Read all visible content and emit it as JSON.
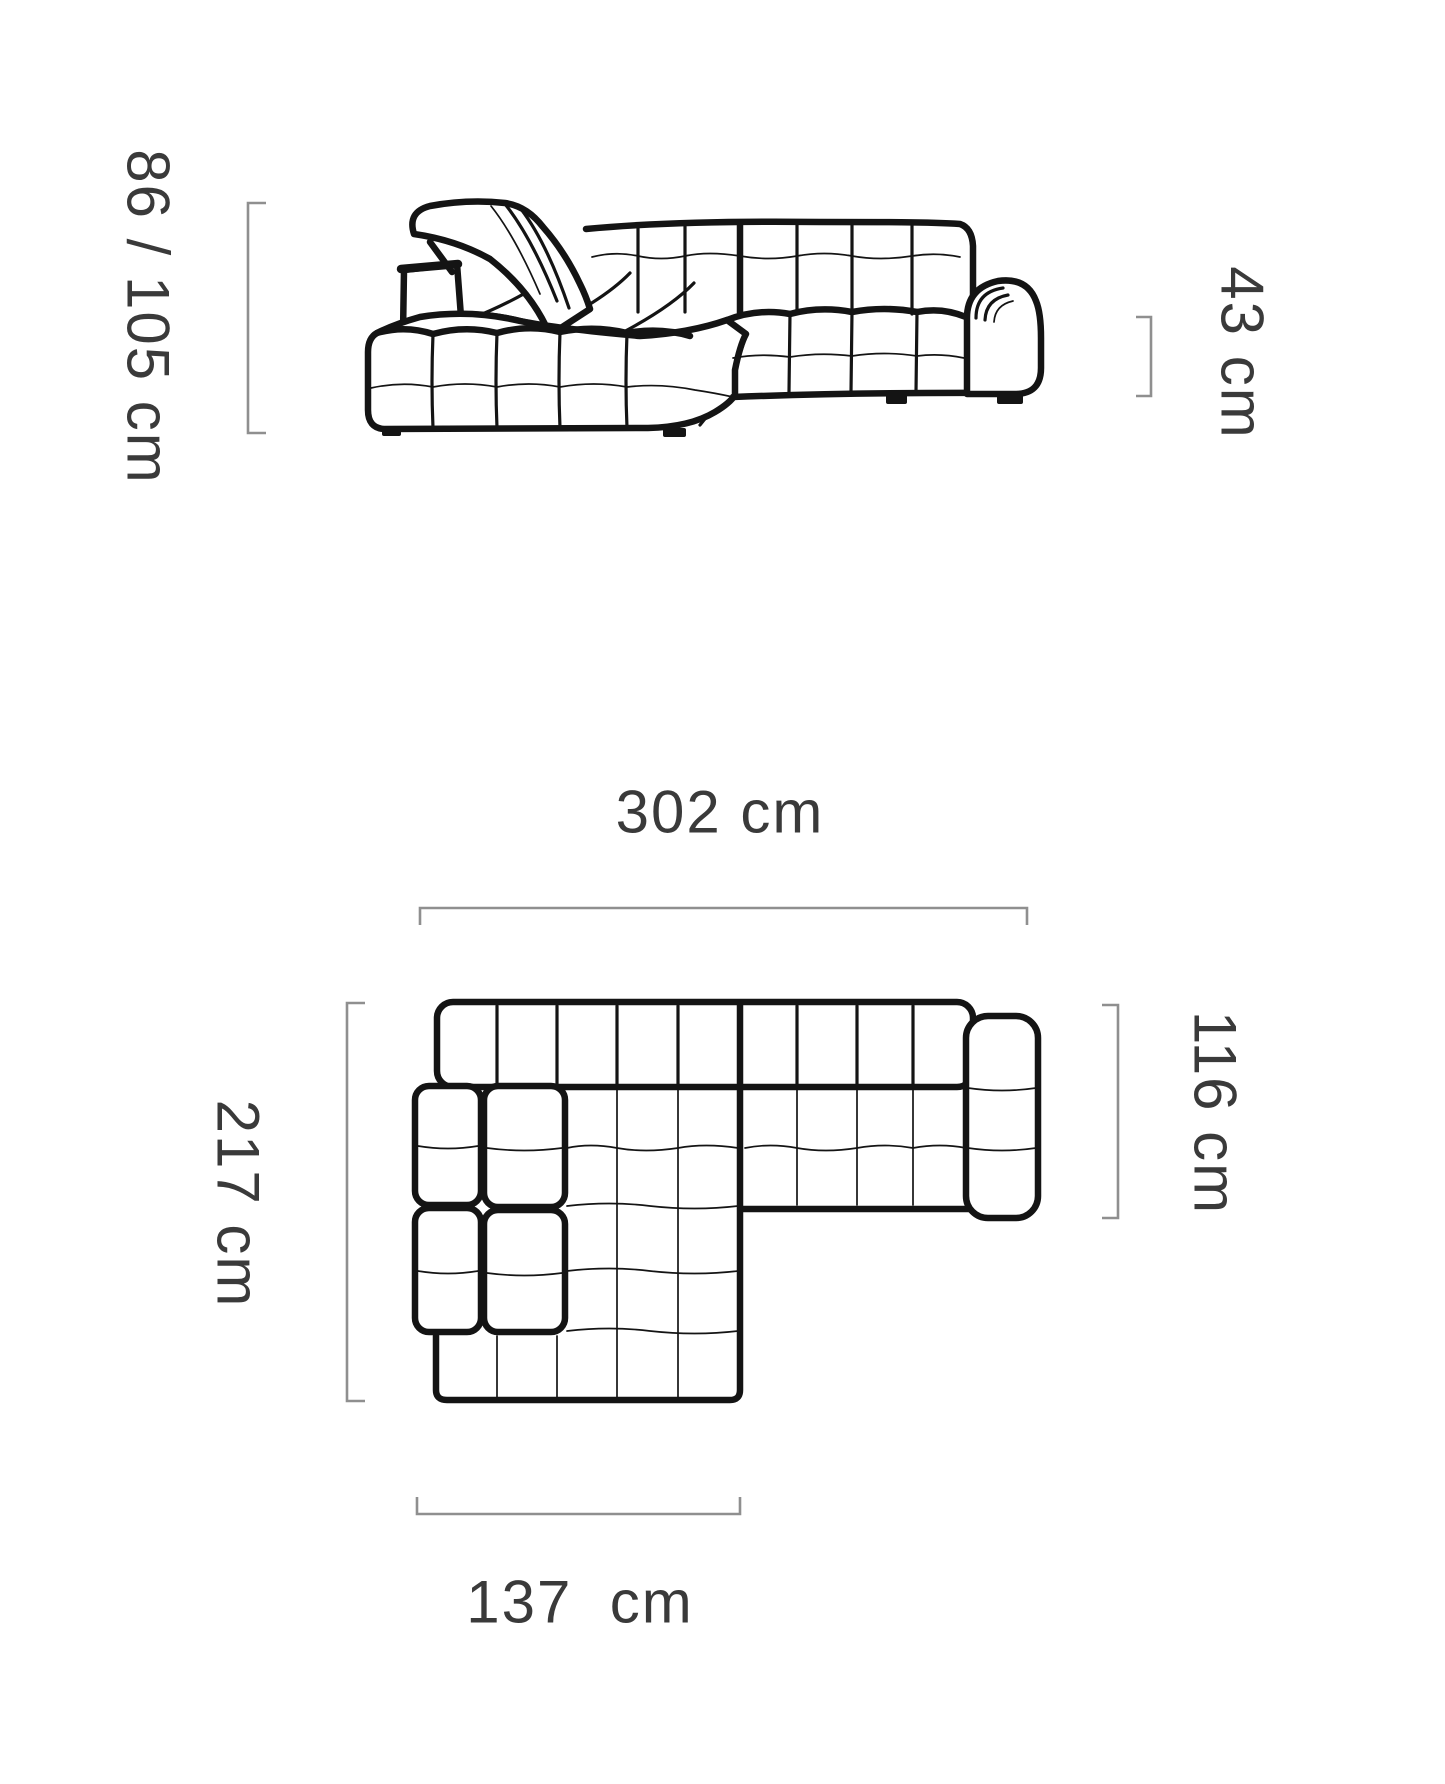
{
  "colors": {
    "line": "#141414",
    "bracket": "#8f8f8f",
    "label": "#3a3a3a",
    "background": "#ffffff"
  },
  "front_view": {
    "height_label": "86 / 105 cm",
    "seat_height_label": "43 cm"
  },
  "top_view": {
    "width_label": "302 cm",
    "depth_label": "217 cm",
    "body_depth_label": "116 cm",
    "chaise_width_label": "137  cm"
  }
}
